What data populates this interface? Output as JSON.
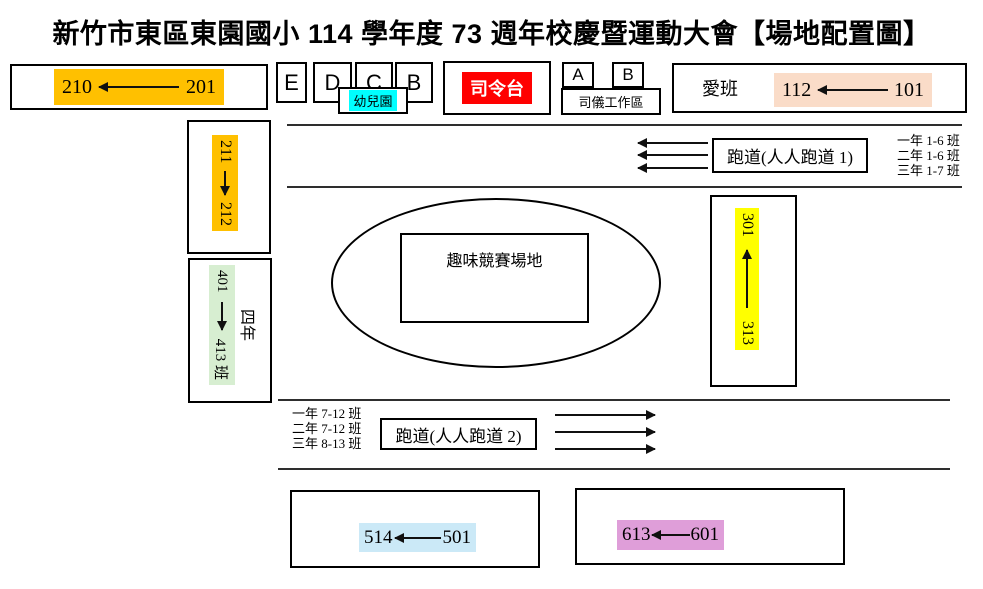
{
  "title": "新竹市東區東園國小 114 學年度 73 週年校慶暨運動大會【場地配置圖】",
  "colors": {
    "orange": "#FFC000",
    "cyan": "#00FFFF",
    "red": "#FF0000",
    "peach": "#FADCC8",
    "light_green": "#D7EED1",
    "yellow": "#FFFF00",
    "light_blue": "#CBE9F7",
    "pink": "#DF9ED9"
  },
  "top_row": {
    "grade2_range": {
      "to": "210",
      "from": "201"
    },
    "stand_e": "E",
    "stand_d": "D",
    "stand_c": "C",
    "stand_b": "B",
    "kindergarten": "幼兒園",
    "stage": "司令台",
    "stand_a2": "A",
    "stand_b2": "B",
    "announcer_area": "司儀工作區",
    "love_class": "愛班",
    "grade1_range": {
      "to": "112",
      "from": "101"
    }
  },
  "left_column": {
    "grade2b_range": {
      "from": "211",
      "to": "212"
    },
    "grade4_range": {
      "from": "401",
      "to": "413 班"
    },
    "grade4_label": "四年"
  },
  "track1": {
    "label": "跑道(人人跑道 1)",
    "classes": [
      "一年 1-6 班",
      "二年 1-6 班",
      "三年 1-7 班"
    ]
  },
  "field": {
    "label": "趣味競賽場地"
  },
  "right_column": {
    "grade3_range": {
      "to": "301",
      "from": "313"
    }
  },
  "track2": {
    "label": "跑道(人人跑道 2)",
    "classes": [
      "一年 7-12 班",
      "二年 7-12 班",
      "三年 8-13 班"
    ]
  },
  "bottom_row": {
    "grade5_range": {
      "to": "514",
      "from": "501"
    },
    "grade6_range": {
      "to": "613",
      "from": "601"
    }
  }
}
